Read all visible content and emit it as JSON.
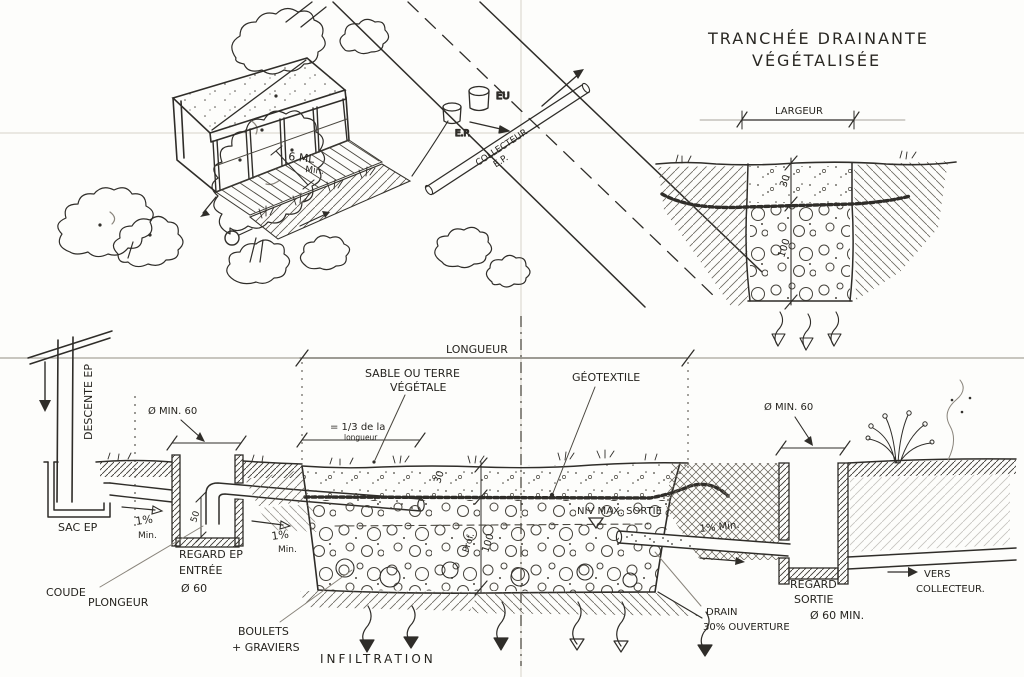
{
  "title": {
    "line1": "TRANCHÉE DRAINANTE",
    "line2": "VÉGÉTALISÉE"
  },
  "detail": {
    "largeur": "LARGEUR",
    "dim_top": "30",
    "dim_bottom": "100"
  },
  "site_plan": {
    "setback_line1": "6.ML",
    "setback_line2": "Min.",
    "eu": "EU",
    "ep": "E.P.",
    "collecteur_line1": "COLLECTEUR",
    "collecteur_line2": "E.P."
  },
  "section": {
    "descente_ep": "DESCENTE EP",
    "sac_ep": "SAC EP",
    "diam_min_60_left": "Ø MIN. 60",
    "slope_left_pct": "1%",
    "slope_left_min": "Min.",
    "regard_entree_line1": "REGARD EP",
    "regard_entree_line2": "ENTRÉE",
    "regard_entree_line3": "Ø 60",
    "coude_line1": "COUDE",
    "coude_line2": "PLONGEUR",
    "dim_50": "50",
    "slope_mid_pct": "1%",
    "slope_mid_min": "Min.",
    "longueur": "LONGUEUR",
    "sable_line1": "SABLE OU TERRE",
    "sable_line2": "VÉGÉTALE",
    "geotextile": "GÉOTEXTILE",
    "half_line1": "= 1/3 de la",
    "half_line2": "longueur",
    "dim_30": "30",
    "prof": "Prof.",
    "dim_100": "100",
    "niv_max": "NIV MAX. SORTIE",
    "slope_right": "1% Min.",
    "diam_min_60_right": "Ø MIN. 60",
    "boulets_line1": "BOULETS",
    "boulets_line2": "+ GRAVIERS",
    "infiltration": "INFILTRATION",
    "drain_line1": "DRAIN",
    "drain_line2": "30% OUVERTURE",
    "regard_sortie_line1": "REGARD",
    "regard_sortie_line2": "SORTIE",
    "regard_sortie_line3": "Ø 60 MIN.",
    "vers_line1": "VERS",
    "vers_line2": "COLLECTEUR."
  },
  "colors": {
    "ink": "#2f2d29",
    "pencil": "#8a857c",
    "paper": "#fdfdfb"
  }
}
